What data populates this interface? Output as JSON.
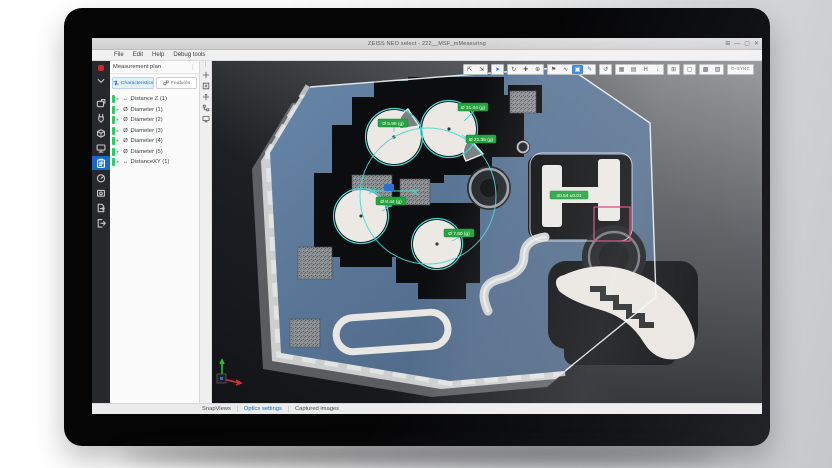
{
  "window": {
    "title": "ZEISS NEO select - 222__MSF_mMeasuring",
    "controls": [
      "⊞",
      "—",
      "▢",
      "✕"
    ]
  },
  "menu": {
    "items": [
      "File",
      "Edit",
      "Help",
      "Debug tools"
    ]
  },
  "panel": {
    "title": "Measurement plan",
    "menu_glyph": "⋮",
    "expander": "▸",
    "tabs": [
      {
        "label": "Characteristics"
      },
      {
        "label": "Features"
      }
    ],
    "tree": [
      {
        "icon": "↔",
        "label": "Distance Z (1)"
      },
      {
        "icon": "Ø",
        "label": "Diameter (1)"
      },
      {
        "icon": "Ø",
        "label": "Diameter (2)"
      },
      {
        "icon": "Ø",
        "label": "Diameter (3)"
      },
      {
        "icon": "Ø",
        "label": "Diameter (4)"
      },
      {
        "icon": "Ø",
        "label": "Diameter (5)"
      },
      {
        "icon": "↔",
        "label": "DistanceXY (1)"
      }
    ]
  },
  "strip": {
    "menu_glyph": "⋮"
  },
  "toolbar": {
    "buttons": [
      {
        "glyph": "⇱"
      },
      {
        "glyph": "⇲"
      },
      {
        "glyph": "➤"
      },
      {
        "glyph": "↻"
      },
      {
        "glyph": "✚"
      },
      {
        "glyph": "⊕"
      },
      {
        "glyph": "⚑"
      },
      {
        "glyph": "∿"
      },
      {
        "glyph": "▣"
      },
      {
        "glyph": "✎"
      },
      {
        "glyph": "↺"
      },
      {
        "glyph": "▦"
      },
      {
        "glyph": "▤"
      },
      {
        "glyph": "H"
      },
      {
        "glyph": "↓"
      },
      {
        "glyph": "⊞"
      },
      {
        "glyph": "▢"
      },
      {
        "glyph": "▩"
      },
      {
        "glyph": "▨"
      },
      {
        "glyph": "O-SYNC"
      }
    ]
  },
  "viewport": {
    "labels": [
      {
        "text": "Ø 5.99 (g)"
      },
      {
        "text": "Ø 31.04 (g)"
      },
      {
        "text": "Ø 21.35 (g)"
      },
      {
        "text": "Ø 8.44 (g)"
      },
      {
        "text": "Ø 7.50 (g)"
      },
      {
        "text": "40.54 ±0.01"
      }
    ]
  },
  "statusbar": {
    "tabs": [
      {
        "label": "SnapViews"
      },
      {
        "label": "Optics settings"
      },
      {
        "label": "Captured images"
      }
    ]
  },
  "colors": {
    "accent": "#1669c9",
    "measure_green": "#23a43f",
    "cyan": "#46d7d4",
    "selection_pink": "#cf3a78",
    "status_green": "#2ecc5e"
  }
}
